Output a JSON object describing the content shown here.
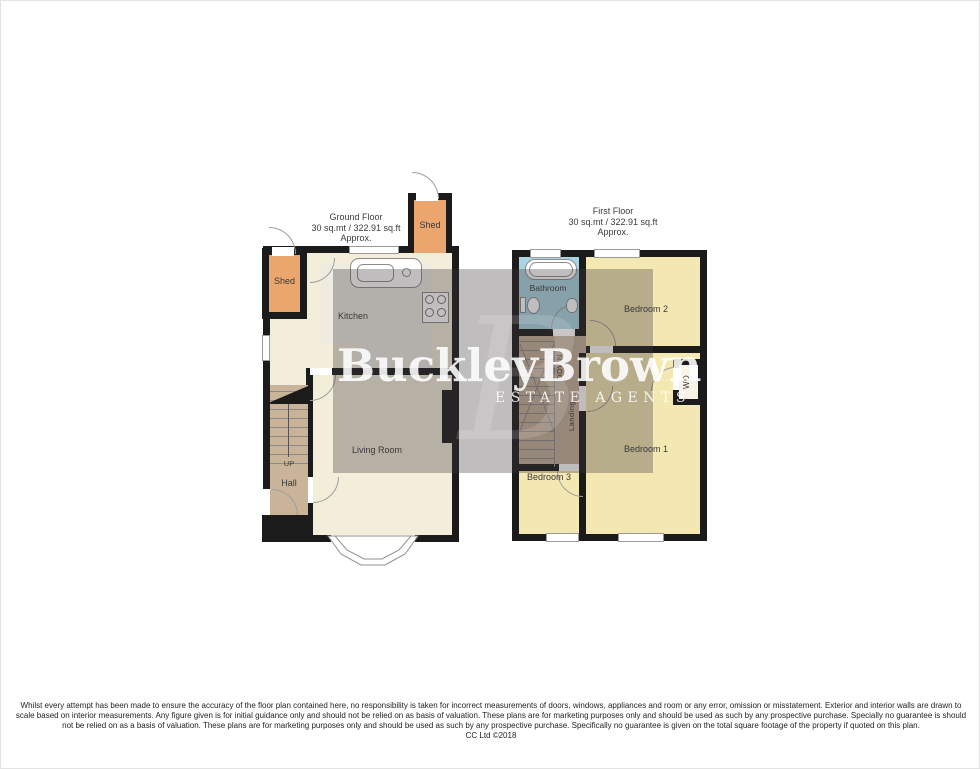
{
  "watermark": {
    "brand": "BuckleyBrown",
    "tagline": "ESTATE AGENTS",
    "monogram": "B"
  },
  "ground_floor": {
    "title": "Ground Floor",
    "area": "30 sq.mt / 322.91 sq.ft",
    "approx": "Approx.",
    "rooms": {
      "kitchen": "Kitchen",
      "living_room": "Living Room",
      "hall": "Hall",
      "shed_left": "Shed",
      "shed_top": "Shed",
      "stairs_direction": "UP"
    }
  },
  "first_floor": {
    "title": "First Floor",
    "area": "30 sq.mt / 322.91 sq.ft",
    "approx": "Approx.",
    "rooms": {
      "bathroom": "Bathroom",
      "bedroom1": "Bedroom 1",
      "bedroom2": "Bedroom 2",
      "bedroom3": "Bedroom 3",
      "landing": "Landing",
      "stairs_direction": "DOWN",
      "wardrobe": "WD"
    }
  },
  "colors": {
    "wall": "#1b1b1b",
    "cream": "#f2eed9",
    "bedroom_yellow": "#f4e8b2",
    "shed_orange": "#eaa66d",
    "hall_tan": "#c9b499",
    "bathroom_blue": "#abd5e2",
    "kitchen_floor": "#eeebe3",
    "overlay": "rgba(60,56,58,0.33)"
  },
  "disclaimer": {
    "lines": [
      "Whilst every attempt has been made to ensure the accuracy of the floor plan contained here, no responsibility is taken for incorrect measurements of doors, windows, appliances and room or any error, omission or misstatement. Exterior and interior walls are drawn to",
      "scale based on interior measurements. Any figure given is for initial guidance only and should not be relied on as basis of valuation. These plans are for marketing purposes only and should be used as such by any prospective purchase. Specially no guarantee is should",
      "not be relied on as a basis of valuation. These plans are for marketing purposes only and should be used as such by any prospective purchase. Specifically no guarantee is given on the total square footage of the property if quoted on this plan."
    ],
    "credit": "CC Ltd ©2018"
  }
}
